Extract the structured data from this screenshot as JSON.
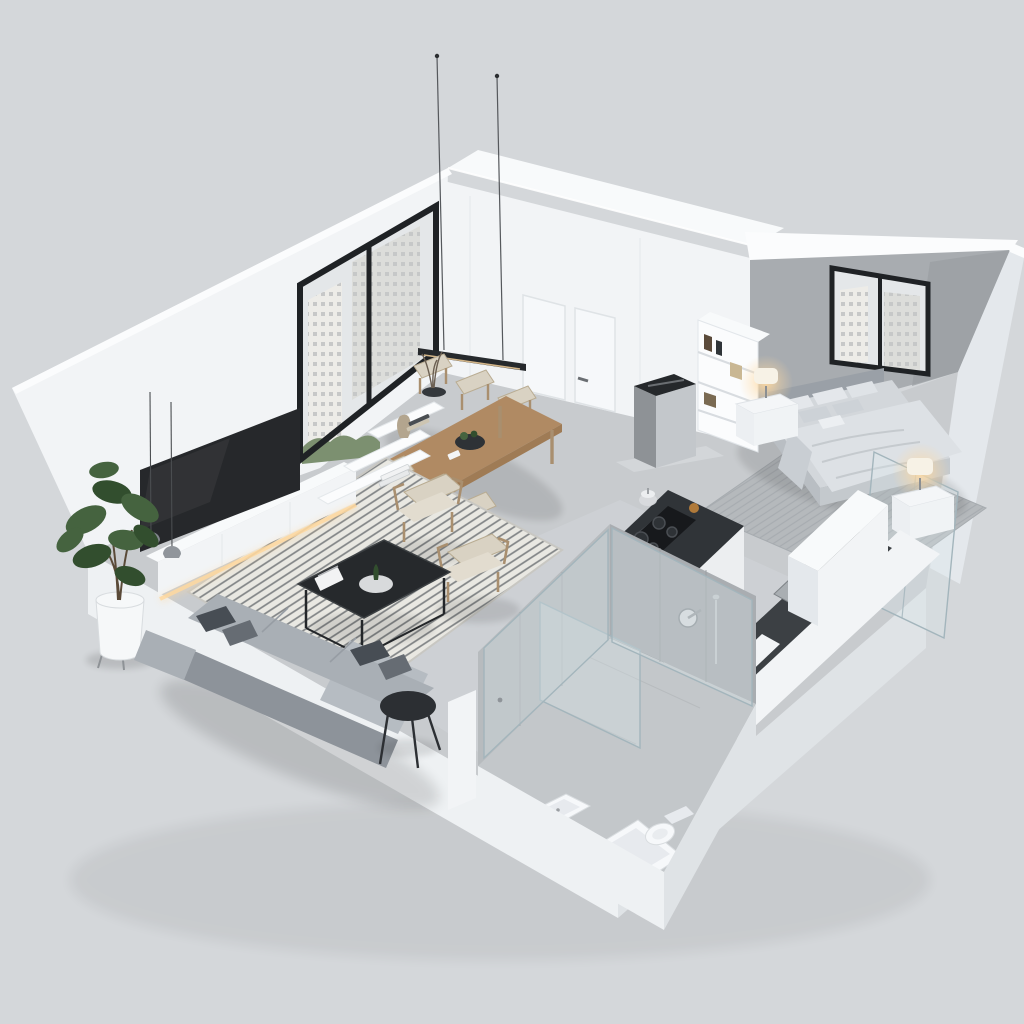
{
  "meta": {
    "title": "3D isometric cutaway floor plan of a minimalist studio apartment",
    "view": "axonometric bird's-eye, walls cut away on the lower-left and lower-right",
    "style": "white and gray minimalist render"
  },
  "colors": {
    "background": "#d4d7da",
    "wall": "#f2f4f6",
    "wall_bright": "#fbfcfd",
    "wall_shade": "#e4e8ec",
    "volume_top": "#f8fafb",
    "floor": "#c8cbce",
    "plinth": "#eef1f3",
    "plinth_shade": "#dfe3e6",
    "accent_wall": "#a8acb0",
    "window_frame": "#1f2225",
    "city_sky": "#e4e7e9",
    "city_building_a": "#edece8",
    "city_building_b": "#dcddda",
    "city_trees": "#7c9070",
    "glass_fill": "#dce8ec",
    "glass_stroke": "#a3b5bc",
    "island_top": "#303438",
    "island_side_dark": "#3a3e42",
    "island_side_white": "#eceef0",
    "counter_dark": "#3c4044",
    "cooktop": "#17191c",
    "wood": "#b08a63",
    "wood_dark": "#91704e",
    "chair_beige": "#d9d2c3",
    "chair_wood": "#a98f6f",
    "rug_base": "#e9e8e2",
    "rug_stripe": "#5f6267",
    "bedroom_rug": "#b5b9bc",
    "sofa": "#a9afb5",
    "sofa_light": "#b6bcc2",
    "sofa_dark": "#8d939a",
    "pillow_dark_a": "#474d54",
    "pillow_dark_b": "#666c73",
    "bed_mattress": "#d3d7db",
    "bed_duvet": "#dde1e5",
    "bed_duvet_shade": "#c9ced3",
    "bed_headboard": "#9aa0a7",
    "bed_base": "#b9bec3",
    "nightstand": "#f4f6f8",
    "lamp_shade": "#f7f2e6",
    "warm_glow": "#ffd9a0",
    "metal": "#c3c7cb",
    "metal_dark": "#8e9296",
    "tv": "#26282b",
    "black_furniture": "#26292c",
    "plant_green": "#45633f",
    "plant_green_dark": "#324e2e",
    "planter": "#f6f8f9",
    "tile_wall": "#b7bbbe",
    "tile_wall_dark": "#a9adb1",
    "tile_floor": "#c3c7ca",
    "fixture_white": "#f6f8fa",
    "fixture_shade": "#e7eaee"
  },
  "scene": {
    "windows": 2,
    "flush_doors": 2,
    "pendant_suspension_wires": 2,
    "rooms": [
      {
        "name": "Living room",
        "furniture": [
          "L-shaped gray sectional sofa with dark throw pillows",
          "black round side table",
          "black metal-frame coffee table with magazine, tray and cactus",
          "black-and-white striped area rug",
          "two beige wood-frame armchairs",
          "wall-mounted flat TV",
          "white floating media console with warm under-lighting",
          "stepped white wall shelves with vase, books and branch decor",
          "two small gray mini pendant lamps",
          "fiddle-leaf fig plant in white footed planter",
          "floor-to-ceiling window with city skyline view"
        ]
      },
      {
        "name": "Dining area",
        "furniture": [
          "rectangular wooden dining table",
          "six beige upholstered dining chairs",
          "black linear pendant light on two thin suspension wires",
          "dark centerpiece bowl with greenery"
        ]
      },
      {
        "name": "Kitchen",
        "furniture": [
          "dark marble waterfall island with induction cooktop and kettle",
          "brushed stainless hood column on metal base",
          "dark stone perimeter counter with undermount sink and chrome faucet",
          "tall white cabinet block",
          "silver decor object on counter"
        ]
      },
      {
        "name": "Bedroom",
        "furniture": [
          "gray upholstered double bed with duvet and pillows",
          "concrete-gray accent wall",
          "black-framed window with city view",
          "two white nightstands with lit table lamps",
          "white bookshelf with books",
          "gray area rug",
          "glass partition toward kitchen"
        ]
      },
      {
        "name": "Bathroom",
        "furniture": [
          "glass shower enclosure",
          "wall-mounted round shower mixer and riser rail",
          "square white basin",
          "built-in white bathtub",
          "white toilet",
          "gray tiled walls and floor"
        ]
      }
    ]
  }
}
